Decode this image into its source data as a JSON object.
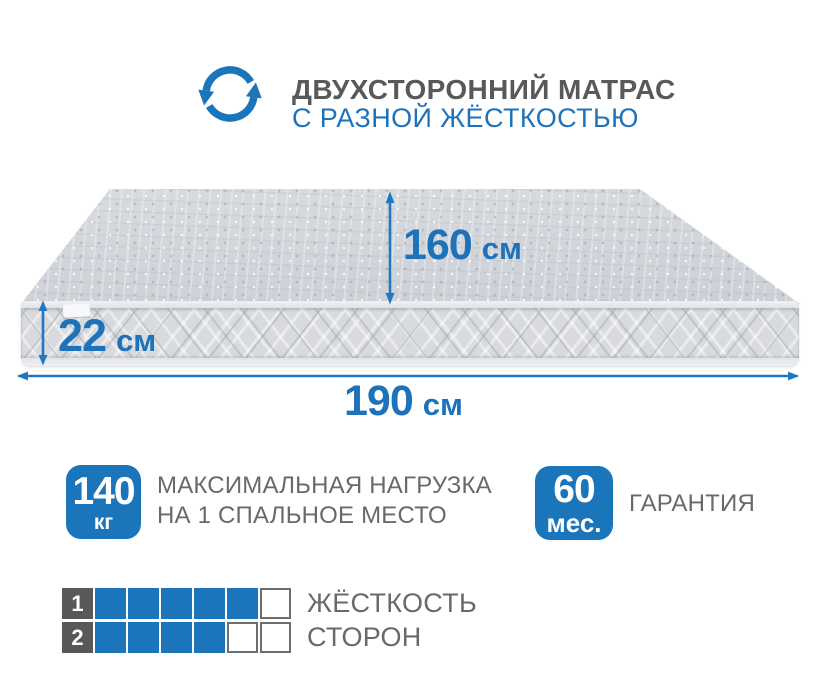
{
  "colors": {
    "accent": "#1b75bb",
    "accent_text": "#1e72ba",
    "arrow": "#2277c2",
    "title_gray": "#58595b",
    "text_gray": "#68696b"
  },
  "header": {
    "icon": "rotate-arrows-icon",
    "title": "ДВУХСТОРОННИЙ МАТРАС",
    "subtitle": "С РАЗНОЙ ЖЁСТКОСТЬЮ"
  },
  "mattress": {
    "width": {
      "value": "160",
      "unit": "см"
    },
    "height": {
      "value": "22",
      "unit": "см"
    },
    "length": {
      "value": "190",
      "unit": "см"
    }
  },
  "features": {
    "max_load": {
      "badge_value": "140",
      "badge_unit": "кг",
      "line1": "МАКСИМАЛЬНАЯ НАГРУЗКА",
      "line2": "НА 1 СПАЛЬНОЕ МЕСТО"
    },
    "warranty": {
      "badge_value": "60",
      "badge_unit": "мес.",
      "label": "ГАРАНТИЯ"
    }
  },
  "ratings": {
    "rows": [
      {
        "label": "1",
        "filled": 5,
        "total": 6,
        "text": "ЖЁСТКОСТЬ"
      },
      {
        "label": "2",
        "filled": 4,
        "total": 6,
        "text": "СТОРОН"
      }
    ]
  }
}
